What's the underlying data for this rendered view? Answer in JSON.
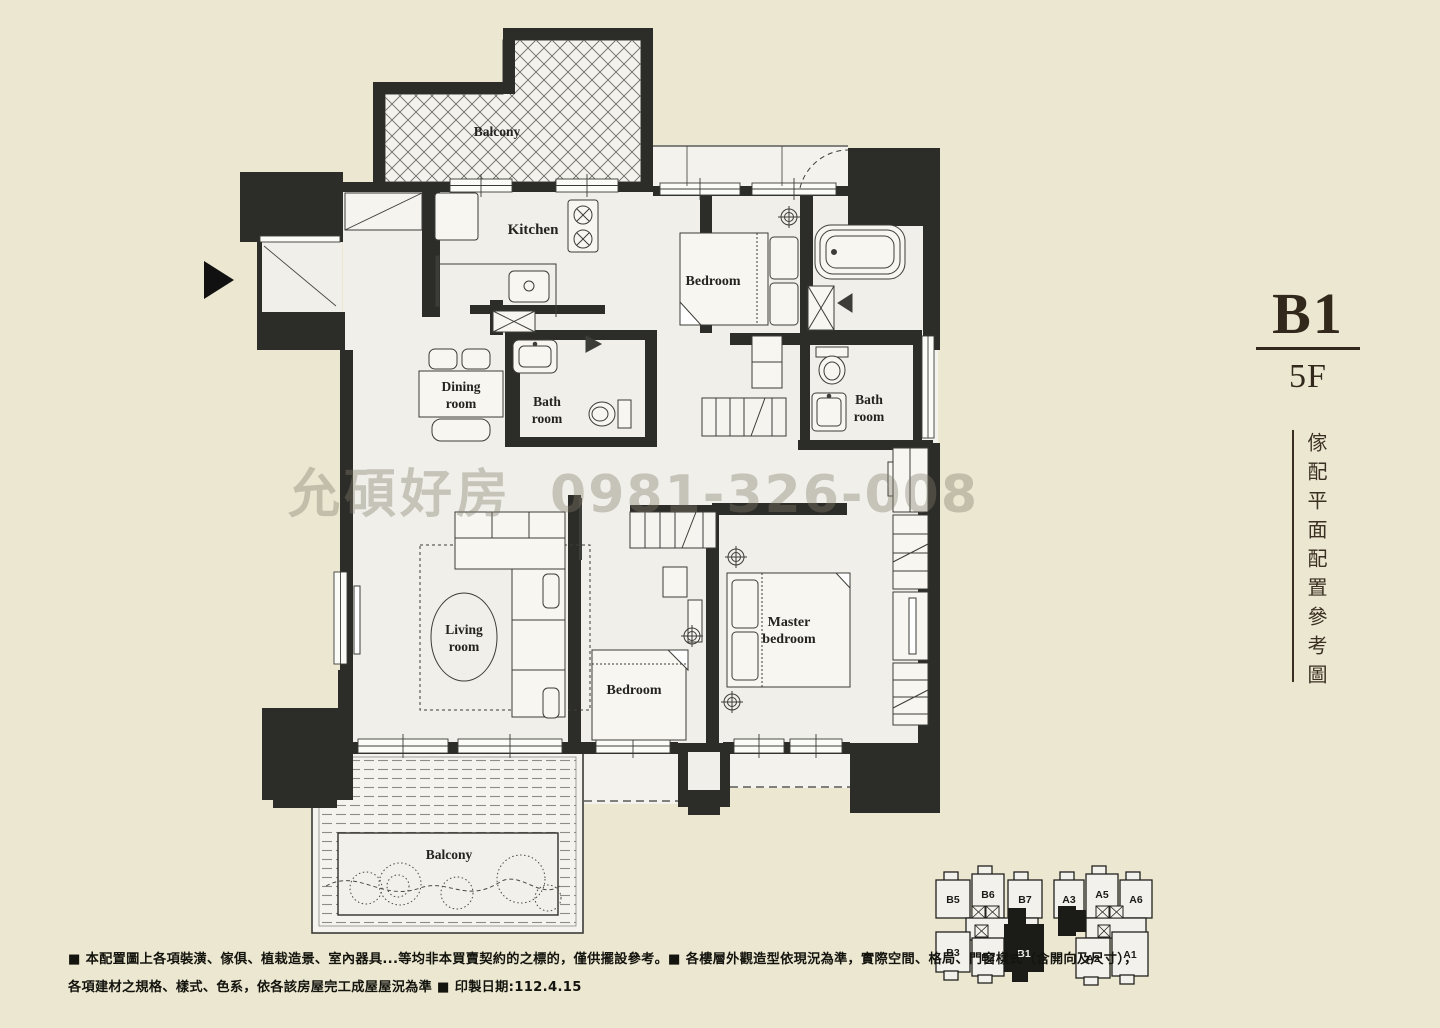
{
  "document": {
    "type": "apartment floor plan"
  },
  "title": {
    "unit": "B1",
    "floor": "5F",
    "caption": "傢配平面配置參考圖"
  },
  "watermark": {
    "name": "允碩好房",
    "phone": "0981-326-008"
  },
  "rooms": {
    "balcony_top": "Balcony",
    "kitchen": "Kitchen",
    "bedroom_top": "Bedroom",
    "bath_center": [
      "Bath",
      "room"
    ],
    "dining": [
      "Dining",
      "room"
    ],
    "bath_right": [
      "Bath",
      "room"
    ],
    "living": [
      "Living",
      "room"
    ],
    "bedroom_mid": "Bedroom",
    "master": [
      "Master",
      "bedroom"
    ],
    "balcony_bottom": "Balcony"
  },
  "keyplan": {
    "left_building": [
      "B5",
      "B6",
      "B7",
      "B3",
      "B2",
      "B1"
    ],
    "right_building": [
      "A3",
      "A5",
      "A6",
      "A2",
      "A1"
    ],
    "highlighted_unit": "B1"
  },
  "disclaimer": {
    "line1": "■ 本配置圖上各項裝潢、傢俱、植栽造景、室內器具...等均非本買賣契約的之標的，僅供擺設參考。■ 各樓層外觀造型依現況為準，實際空間、格局、門窗樣式（含開向及尺寸），",
    "line2": "各項建材之規格、樣式、色系，依各該房屋完工成屋屋況為準 ■ 印製日期:112.4.15"
  },
  "colors": {
    "background": "#ece7d1",
    "floor": "#f0efe9",
    "wall": "#2c2c28",
    "watermark_gray": "#827c6c",
    "title_brown": "#32281c"
  }
}
